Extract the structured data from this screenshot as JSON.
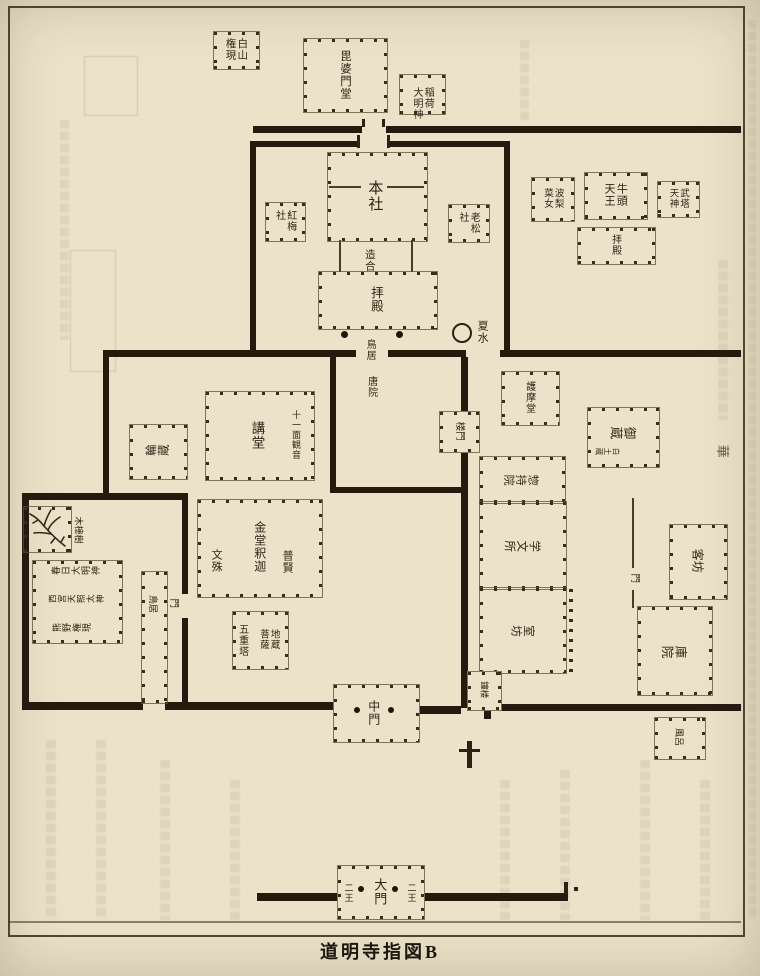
{
  "page": {
    "caption": "道明寺指図B"
  },
  "margin_note": "華",
  "shrine_area": {
    "hakusan_gongen": "白山\n権現",
    "bishamondo": "毘婆門堂",
    "inari_daimyojin": "稲荷\n大明神",
    "honsha": "本社",
    "kobai_sha": "紅梅\n社",
    "oimatsu_sha": "老松\n社",
    "tsukuriai": "造合",
    "haiden": "拝殿",
    "torii": "鳥居",
    "toin": "唐院",
    "natsumizu": "夏水"
  },
  "gozu_area": {
    "harisainyo": "波梨\n菜女",
    "gozu_tenno": "牛頭\n天王",
    "muto_tenjin": "武塔\n天神",
    "haiden": "拝殿"
  },
  "temple_area": {
    "rinzo": "輪蔵",
    "kodo": "講堂",
    "kannon": "十一面観音",
    "kondo_shaka": "金堂釈迦",
    "fugen": "普賢",
    "monju": "文殊",
    "pagoda": "五重塔",
    "jizo_bosatsu": "地蔵\n菩薩",
    "chumon": "中門",
    "daimon": "大門",
    "nio_left": "二王",
    "nio_right": "二王",
    "torii_west": "鳥居",
    "mon_west": "門",
    "mokugenju": "木槵樹",
    "kasuga": "春日大明神",
    "nishinomiya": "西宮天照太神",
    "kumano": "熊野権現"
  },
  "monastery_area": {
    "gomado": "護摩堂",
    "romon": "楼門",
    "okura": "御蔵",
    "okura_note": "白土蔵",
    "sojiin": "惣持院",
    "gakumonjo": "学文所",
    "murobo": "室坊",
    "mon_east": "門",
    "kyakubo": "客坊",
    "kuin": "庫院",
    "shoro": "鐘楼",
    "furo": "風呂"
  }
}
